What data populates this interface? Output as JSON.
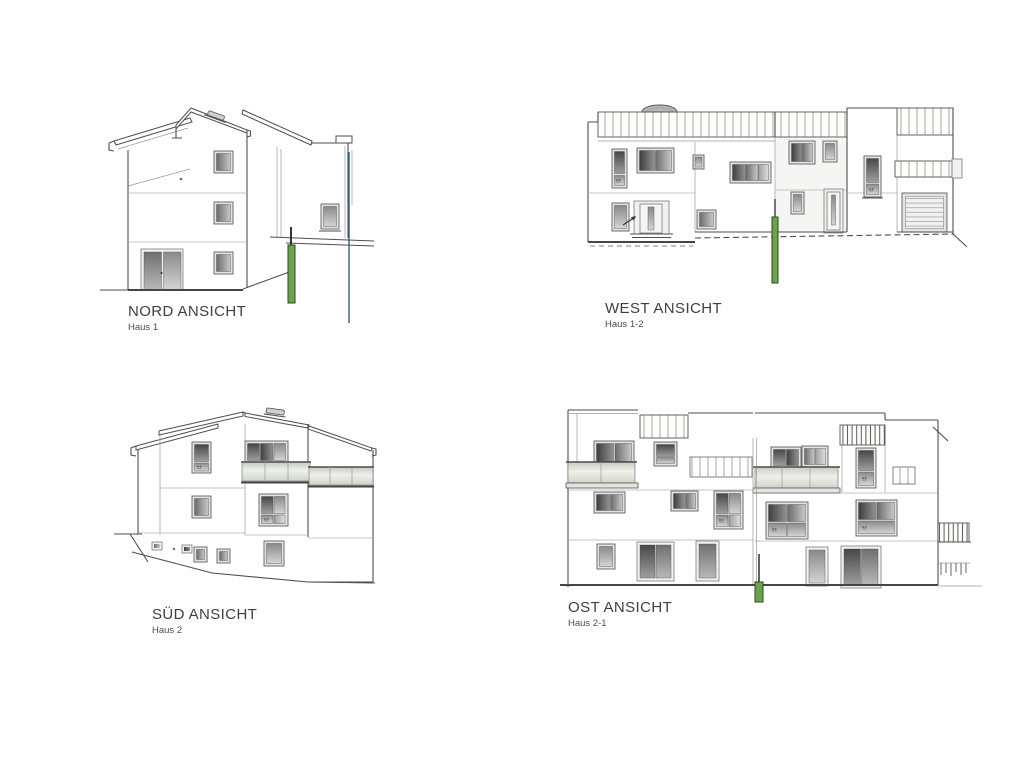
{
  "colors": {
    "label": "#3f3f3f",
    "sublabel": "#4c4c4c",
    "line": "#4e4e4e",
    "green_post": "#6da24e",
    "green_post_dark": "#2c4a1c",
    "blue_line": "#2e5e8e",
    "balustrade_tint": "#d9dfd2"
  },
  "views": [
    {
      "id": "nord",
      "title": "NORD ANSICHT",
      "subtitle": "Haus 1"
    },
    {
      "id": "west",
      "title": "WEST ANSICHT",
      "subtitle": "Haus 1-2"
    },
    {
      "id": "sued",
      "title": "SÜD ANSICHT",
      "subtitle": "Haus 2"
    },
    {
      "id": "ost",
      "title": "OST ANSICHT",
      "subtitle": "Haus 2-1"
    }
  ]
}
